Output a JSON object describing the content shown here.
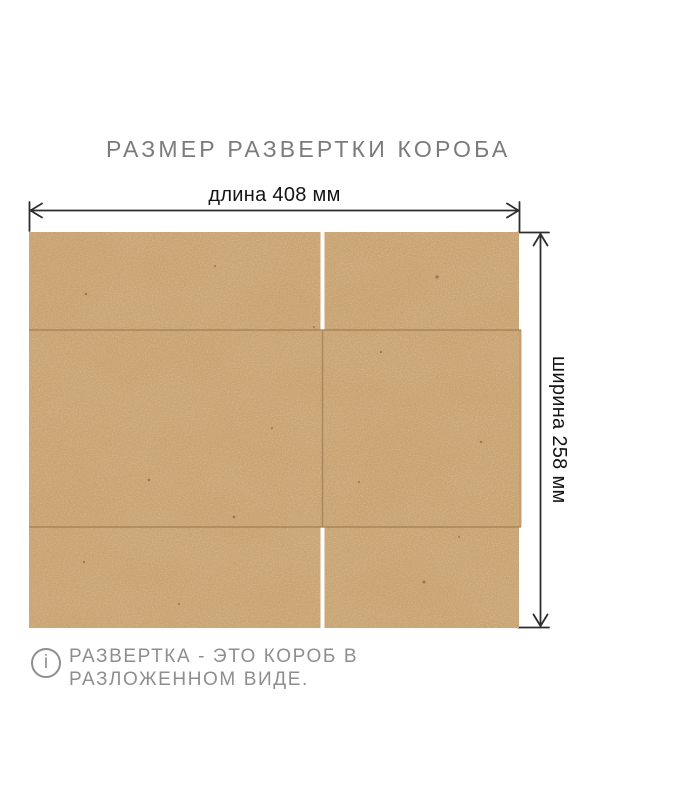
{
  "page": {
    "title": "РАЗМЕР РАЗВЕРТКИ КОРОБА",
    "background": "#ffffff"
  },
  "diagram": {
    "type": "box-unfolding-dimension-diagram",
    "length_label": "длина 408 мм",
    "width_label": "ширина 258 мм",
    "length_mm": 408,
    "width_mm": 258,
    "material": "kraft-cardboard",
    "panels": {
      "rows": 3,
      "top_row": "two flaps separated by a cut slit",
      "middle_row": "two panels separated by a vertical fold line",
      "bottom_row": "two flaps separated by a cut slit"
    }
  },
  "note": {
    "icon": "info-icon",
    "icon_glyph": "i",
    "text": "РАЗВЕРТКА - ЭТО КОРОБ В РАЗЛОЖЕННОМ ВИДЕ."
  },
  "colors": {
    "kraft_base": "#c9a372",
    "fold_line": "#9c7c50",
    "cut_slit": "#ffffff",
    "dimension_line": "#2e2e2e",
    "dimension_text": "#141414",
    "title_text": "#7b7b7b",
    "note_text": "#8e8e8e"
  }
}
